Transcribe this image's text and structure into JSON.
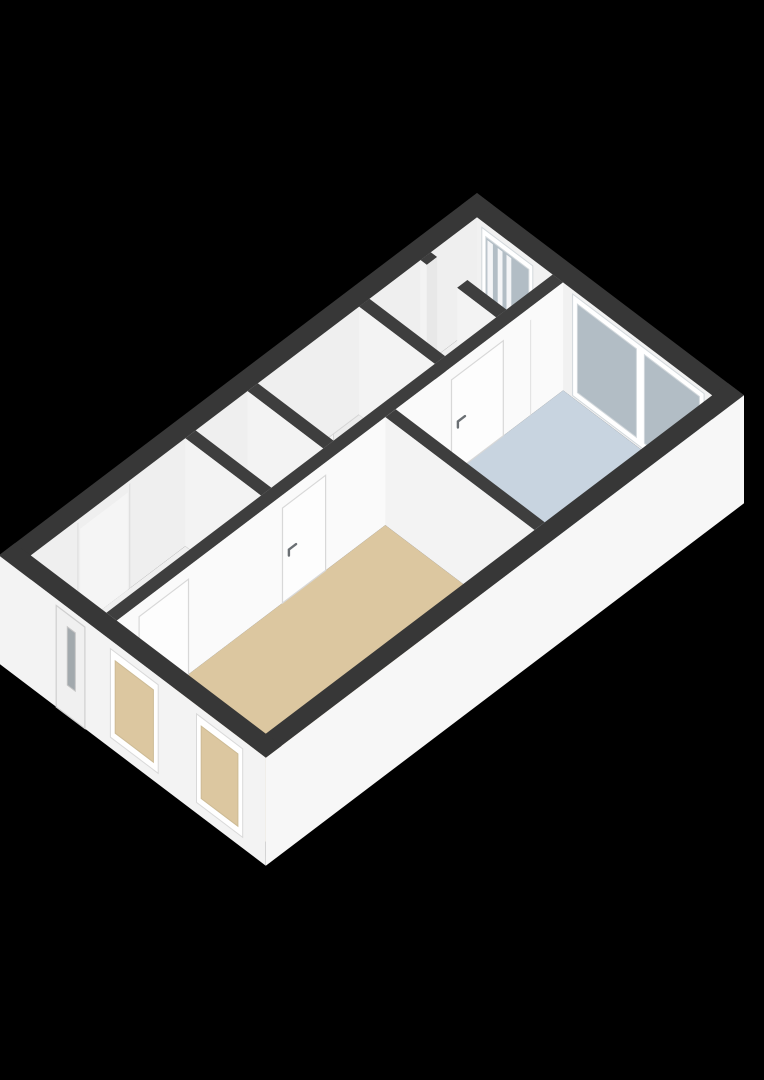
{
  "scene": {
    "width": 764,
    "height": 1080,
    "background": "#000000",
    "description": "isometric-3d-floorplan"
  },
  "projection": {
    "ox": 477,
    "oy": 193,
    "kx": 0.797,
    "ky": 0.604,
    "wall_height": 108
  },
  "palette": {
    "background": "#000000",
    "wall_top_exterior": "#373737",
    "wall_top_interior": "#3e3e3e",
    "wall_face_inner": "#f1f1f1",
    "wall_face_left": "#efefef",
    "wall_face_spine": "#fafafa",
    "wall_face_partition": "#f3f3f3",
    "apron_right": "#f7f7f7",
    "apron_front": "#f3f3f3",
    "floor_white": "#efefef",
    "floor_beige": "#dcc7a0",
    "floor_blue": "#c8d4e0",
    "glass": "#b2bdc5",
    "glass_dark": "#a2a9ad",
    "frame_white": "#ffffff",
    "frame_edge": "#d2d8dc",
    "door_leaf": "#fdfdfd",
    "door_edge": "#d8d8d8",
    "handle": "#6a6f73",
    "stair_light": "#f6f6f6",
    "stair_dark": "#ececec",
    "stair_edge": "#d5d5d5",
    "toilet_white": "#ffffff",
    "toilet_gray": "#9aa0a4",
    "toilet_red": "#a94540",
    "seam": "#dfdfdf",
    "reveal": "#e8e8e8"
  },
  "building": {
    "plan_width": 335,
    "plan_length": 600,
    "exterior_wall_thickness": 20
  },
  "exterior_walls": [
    {
      "name": "wall-top-upper-right",
      "rect": [
        0,
        0,
        335,
        20
      ]
    },
    {
      "name": "wall-top-upper-left",
      "rect": [
        0,
        0,
        20,
        600
      ]
    },
    {
      "name": "wall-top-lower-right",
      "rect": [
        315,
        0,
        335,
        600
      ]
    },
    {
      "name": "wall-top-lower-left",
      "rect": [
        0,
        580,
        335,
        600
      ]
    }
  ],
  "rooms": [
    {
      "name": "room-top",
      "floor": "floor_white",
      "rect": [
        20,
        20,
        115,
        78
      ]
    },
    {
      "name": "landing",
      "floor": "floor_white",
      "rect": [
        20,
        91,
        115,
        155
      ]
    },
    {
      "name": "staircase-room",
      "floor": "floor_white",
      "rect": [
        20,
        168,
        115,
        295
      ]
    },
    {
      "name": "wc",
      "floor": "floor_white",
      "rect": [
        20,
        308,
        115,
        373
      ]
    },
    {
      "name": "hallway",
      "floor": "floor_white",
      "rect": [
        20,
        386,
        115,
        580
      ]
    },
    {
      "name": "bedroom",
      "floor": "floor_blue",
      "rect": [
        128,
        20,
        315,
        230
      ]
    },
    {
      "name": "living-room",
      "floor": "floor_beige",
      "rect": [
        128,
        243,
        315,
        580
      ]
    }
  ],
  "interior_walls": [
    {
      "name": "room-top-south-wall-left",
      "rect": [
        20,
        78,
        28,
        91
      ],
      "face": "south",
      "reveal_east": true
    },
    {
      "name": "room-top-south-wall-right",
      "rect": [
        66,
        78,
        115,
        91
      ],
      "face": "south"
    },
    {
      "name": "landing-staircase-wall",
      "rect": [
        20,
        155,
        115,
        168
      ],
      "face": "south"
    },
    {
      "name": "staircase-wc-wall",
      "rect": [
        20,
        295,
        115,
        308
      ],
      "face": "south"
    },
    {
      "name": "wc-hallway-wall",
      "rect": [
        20,
        373,
        115,
        386
      ],
      "face": "south"
    }
  ],
  "spine_wall": {
    "name": "spine-wall",
    "rect": [
      115,
      20,
      128,
      580
    ],
    "wardrobe_seam_y": [
      60,
      61.5
    ]
  },
  "bedroom_south_wall": {
    "name": "bedroom-south-wall",
    "rect": [
      128,
      230,
      315,
      243
    ]
  },
  "spine_doors": [
    {
      "name": "bedroom-door",
      "y": [
        95,
        160
      ],
      "z": 0.88,
      "handle_y": 152,
      "handle_z": 0.45
    },
    {
      "name": "wc-door",
      "y": [
        318,
        372
      ],
      "z": 0.88,
      "handle_y": 364,
      "handle_z": 0.45
    },
    {
      "name": "hallway-door",
      "y": [
        490,
        552
      ],
      "z": 0.88,
      "handle_y": 544,
      "handle_z": 0.45
    }
  ],
  "room_top_window": {
    "frame_x": [
      26,
      90
    ],
    "frame_z": [
      0.08,
      0.94
    ],
    "glass_x": [
      31,
      85
    ],
    "glass_z": [
      0.14,
      0.88
    ],
    "curtains": [
      [
        33,
        40
      ],
      [
        46,
        52
      ],
      [
        57,
        63
      ]
    ]
  },
  "bedroom_glazing": {
    "frame_x": [
      140,
      305
    ],
    "frame_z": [
      0.02,
      0.96
    ],
    "glass_z": [
      0.08,
      0.9
    ],
    "panes": [
      [
        146,
        220
      ],
      [
        230,
        299
      ]
    ]
  },
  "left_wall_details": {
    "panel_y": [
      458,
      518
    ],
    "seams_y": [
      455,
      520
    ]
  },
  "facade_windows": [
    {
      "name": "living-room-window-1",
      "x": [
        140,
        200
      ],
      "frame_z": [
        0.1,
        0.92
      ],
      "aperture_z": [
        0.17,
        0.84
      ]
    },
    {
      "name": "living-room-window-2",
      "x": [
        248,
        306
      ],
      "frame_z": [
        0.1,
        0.92
      ],
      "aperture_z": [
        0.17,
        0.84
      ]
    }
  ],
  "entry_door": {
    "name": "entry-door",
    "x": [
      72,
      108
    ],
    "z": [
      0.0,
      0.94
    ],
    "glass_x": [
      86,
      96
    ],
    "glass_z": [
      0.28,
      0.82
    ]
  },
  "staircase": {
    "pivot": [
      112,
      292
    ],
    "wedges": [
      [
        [
          112,
          292
        ],
        [
          20,
          292
        ],
        [
          20,
          267
        ]
      ],
      [
        [
          112,
          292
        ],
        [
          20,
          267
        ],
        [
          20,
          239
        ]
      ],
      [
        [
          112,
          292
        ],
        [
          20,
          239
        ],
        [
          20,
          200
        ]
      ],
      [
        [
          112,
          292
        ],
        [
          20,
          200
        ],
        [
          20,
          168
        ],
        [
          40,
          168
        ]
      ],
      [
        [
          112,
          292
        ],
        [
          40,
          168
        ],
        [
          79,
          168
        ]
      ],
      [
        [
          112,
          292
        ],
        [
          79,
          168
        ],
        [
          112,
          168
        ]
      ]
    ]
  },
  "toilet": {
    "tank": [
      22,
      312,
      34,
      344
    ],
    "bowl": [
      34,
      317,
      50,
      339
    ],
    "seat": [
      40,
      321,
      48,
      335
    ],
    "accent": [
      35,
      322,
      40,
      334
    ]
  }
}
